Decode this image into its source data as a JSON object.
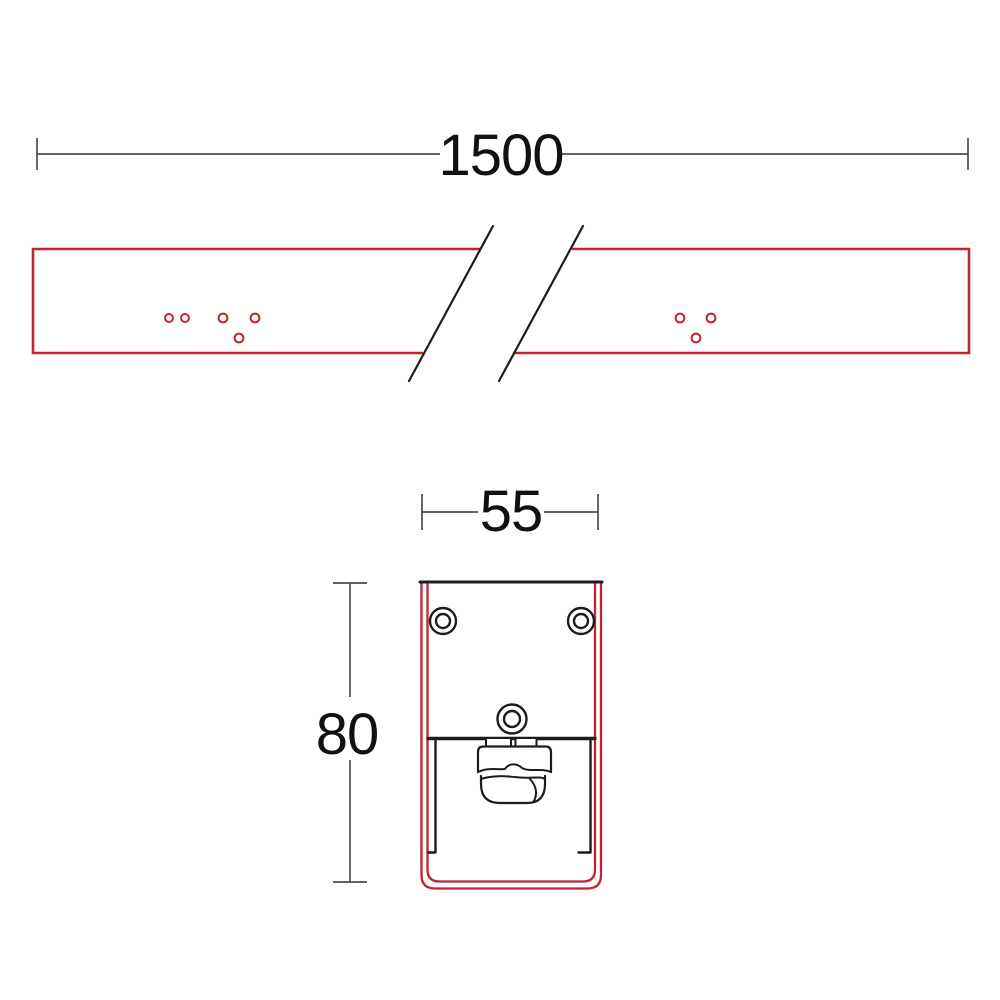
{
  "drawing": {
    "type": "technical-dimension-drawing",
    "background": "#ffffff",
    "colors": {
      "profile_outline": "#c22433",
      "detail_lines": "#1c1c1c",
      "dimension_lines": "#4d4d4d",
      "dimension_text": "#111111",
      "fill_white": "#ffffff"
    },
    "front_view": {
      "length_dimension_label": "1500",
      "hole_count_left_group": 5,
      "hole_count_right_group": 3
    },
    "section_view": {
      "width_dimension_label": "55",
      "height_dimension_label": "80",
      "screw_count": 3
    }
  }
}
